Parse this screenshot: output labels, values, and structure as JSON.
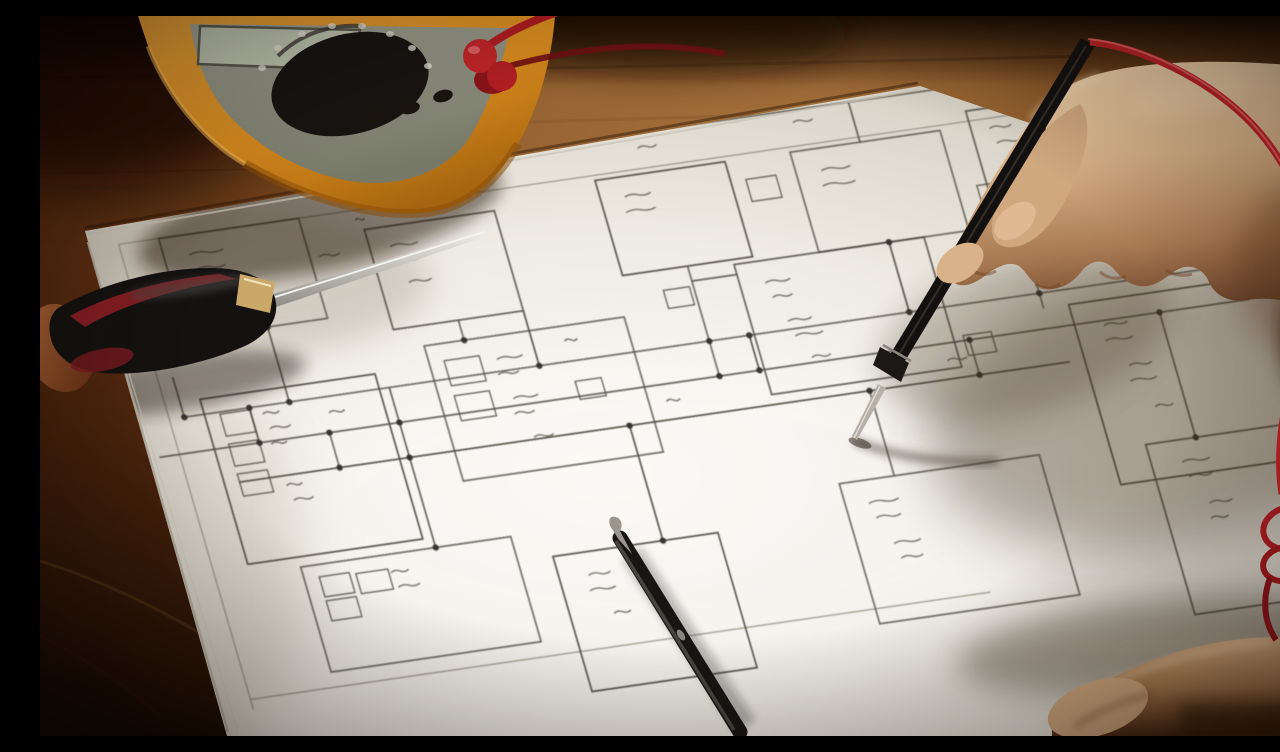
{
  "scene": {
    "description": "Close-up photograph of an electronics workbench: a hand holds a black multimeter test probe with a red lead against a hand-drawn electrical schematic on white paper; a yellow digital multimeter sits at top left with red leads plugged in, a black-and-red screwdriver lies on the left, a black pen rests at bottom center, a second hand rests at bottom right, all on a warm brown wooden desk.",
    "objects": [
      {
        "name": "wooden-desk",
        "color": "#7c4b20"
      },
      {
        "name": "schematic-paper",
        "color": "#efece5"
      },
      {
        "name": "schematic-drawing",
        "color": "#4e4a42"
      },
      {
        "name": "multimeter",
        "color": "#e09a2c"
      },
      {
        "name": "multimeter-display",
        "color": "#c2c8b4"
      },
      {
        "name": "multimeter-dial",
        "color": "#171512"
      },
      {
        "name": "test-lead-plugs",
        "color": "#c0262a"
      },
      {
        "name": "red-test-lead",
        "color": "#bf2327"
      },
      {
        "name": "screwdriver",
        "color": "#141210"
      },
      {
        "name": "pen",
        "color": "#181614"
      },
      {
        "name": "hand-holding-probe",
        "color": "#d8b289"
      },
      {
        "name": "multimeter-probe",
        "color": "#131110"
      },
      {
        "name": "probe-lead-coil",
        "color": "#b01d22"
      },
      {
        "name": "resting-hand",
        "color": "#c89b72"
      }
    ]
  },
  "palette": {
    "wood_light": "#a06b36",
    "wood_mid": "#7c4b20",
    "wood_dark": "#160a03",
    "paper": "#efece5",
    "paper_shadow": "#a89d8d",
    "ink": "#4e4a42",
    "ink_dark": "#33302a",
    "ink_label": "#59554c",
    "sheet_border": "#8f8a7c",
    "meter_body": "#e09a2c",
    "meter_face": "#8f9183",
    "meter_screen": "#c2c8b4",
    "dial": "#171512",
    "lead_red": "#bf2327",
    "probe_black": "#131110",
    "skin_light": "#f0d3ac",
    "skin_dark": "#6d452c",
    "handle_black": "#141210",
    "handle_red": "#8f2025",
    "shaft_metal": "#b9b9b3"
  },
  "schematic": {
    "border": [
      [
        80,
        -5,
        1000,
        -5
      ],
      [
        80,
        -5,
        80,
        460
      ],
      [
        80,
        450,
        820,
        450
      ]
    ],
    "boxes": [
      [
        120,
        -5,
        140,
        100
      ],
      [
        320,
        15,
        130,
        100
      ],
      [
        555,
        0,
        130,
        95
      ],
      [
        750,
        0,
        150,
        100
      ],
      [
        930,
        -15,
        150,
        105
      ],
      [
        115,
        155,
        175,
        165
      ],
      [
        345,
        135,
        200,
        135
      ],
      [
        665,
        100,
        190,
        130
      ],
      [
        975,
        185,
        230,
        180
      ],
      [
        705,
        325,
        200,
        140
      ],
      [
        1010,
        330,
        210,
        170
      ],
      [
        410,
        355,
        165,
        135
      ],
      [
        165,
        330,
        210,
        105
      ]
    ],
    "small_boxes": [
      [
        130,
        172,
        30,
        22
      ],
      [
        130,
        202,
        30,
        22
      ],
      [
        130,
        232,
        30,
        22
      ],
      [
        360,
        152,
        35,
        25
      ],
      [
        360,
        187,
        35,
        25
      ],
      [
        180,
        342,
        30,
        20
      ],
      [
        180,
        366,
        30,
        20
      ],
      [
        216,
        344,
        32,
        20
      ],
      [
        590,
        115,
        26,
        18
      ],
      [
        480,
        190,
        26,
        18
      ],
      [
        865,
        200,
        28,
        20
      ],
      [
        920,
        58,
        26,
        18
      ],
      [
        700,
        20,
        30,
        22
      ],
      [
        975,
        18,
        28,
        20
      ]
    ],
    "lines": [
      [
        95,
        170,
        1180,
        170
      ],
      [
        60,
        205,
        1150,
        205
      ],
      [
        130,
        240,
        900,
        240
      ],
      [
        540,
        -40,
        1100,
        -40
      ],
      [
        200,
        95,
        200,
        170
      ],
      [
        450,
        115,
        450,
        170
      ],
      [
        620,
        95,
        620,
        205
      ],
      [
        820,
        -40,
        820,
        0
      ],
      [
        820,
        100,
        820,
        170
      ],
      [
        950,
        90,
        950,
        185
      ],
      [
        300,
        170,
        300,
        330
      ],
      [
        520,
        240,
        520,
        355
      ],
      [
        760,
        240,
        760,
        325
      ],
      [
        1060,
        205,
        1060,
        330
      ],
      [
        160,
        170,
        160,
        205
      ],
      [
        230,
        205,
        230,
        240
      ],
      [
        620,
        110,
        665,
        110
      ],
      [
        900,
        240,
        960,
        240
      ],
      [
        385,
        115,
        385,
        135
      ],
      [
        95,
        130,
        95,
        170
      ],
      [
        660,
        170,
        660,
        205
      ],
      [
        870,
        205,
        870,
        240
      ]
    ],
    "dots": [
      [
        200,
        170
      ],
      [
        450,
        170
      ],
      [
        620,
        170
      ],
      [
        620,
        205
      ],
      [
        820,
        170
      ],
      [
        950,
        170
      ],
      [
        300,
        205
      ],
      [
        300,
        240
      ],
      [
        520,
        240
      ],
      [
        760,
        240
      ],
      [
        1060,
        205
      ],
      [
        160,
        170
      ],
      [
        160,
        205
      ],
      [
        230,
        205
      ],
      [
        230,
        240
      ],
      [
        95,
        170
      ],
      [
        385,
        135
      ],
      [
        820,
        100
      ],
      [
        660,
        170
      ],
      [
        660,
        205
      ],
      [
        870,
        205
      ],
      [
        870,
        240
      ],
      [
        950,
        90
      ],
      [
        300,
        330
      ],
      [
        520,
        355
      ],
      [
        1060,
        330
      ],
      [
        200,
        95
      ],
      [
        1180,
        170
      ]
    ],
    "labels": [
      [
        145,
        15,
        2,
        34
      ],
      [
        268,
        35,
        1,
        22
      ],
      [
        338,
        35,
        2,
        30
      ],
      [
        345,
        72,
        1,
        26
      ],
      [
        575,
        20,
        2,
        30
      ],
      [
        770,
        22,
        2,
        34
      ],
      [
        948,
        5,
        2,
        28
      ],
      [
        170,
        178,
        3,
        24
      ],
      [
        172,
        250,
        2,
        24
      ],
      [
        408,
        158,
        2,
        26
      ],
      [
        412,
        198,
        2,
        26
      ],
      [
        420,
        238,
        1,
        22
      ],
      [
        690,
        122,
        2,
        28
      ],
      [
        700,
        162,
        2,
        28
      ],
      [
        712,
        200,
        1,
        24
      ],
      [
        1000,
        210,
        2,
        30
      ],
      [
        1012,
        252,
        2,
        30
      ],
      [
        1025,
        295,
        1,
        26
      ],
      [
        728,
        348,
        2,
        30
      ],
      [
        740,
        390,
        2,
        28
      ],
      [
        1038,
        352,
        2,
        30
      ],
      [
        1052,
        395,
        2,
        26
      ],
      [
        435,
        378,
        2,
        26
      ],
      [
        448,
        418,
        1,
        22
      ],
      [
        250,
        348,
        2,
        24
      ],
      [
        480,
        150,
        1,
        20
      ],
      [
        560,
        222,
        1,
        22
      ],
      [
        840,
        222,
        1,
        20
      ],
      [
        940,
        150,
        1,
        20
      ],
      [
        230,
        186,
        1,
        18
      ],
      [
        605,
        -25,
        1,
        22
      ],
      [
        760,
        -28,
        1,
        24
      ],
      [
        960,
        -45,
        1,
        22
      ],
      [
        415,
        -2,
        1,
        20
      ],
      [
        310,
        5,
        1,
        16
      ]
    ]
  }
}
